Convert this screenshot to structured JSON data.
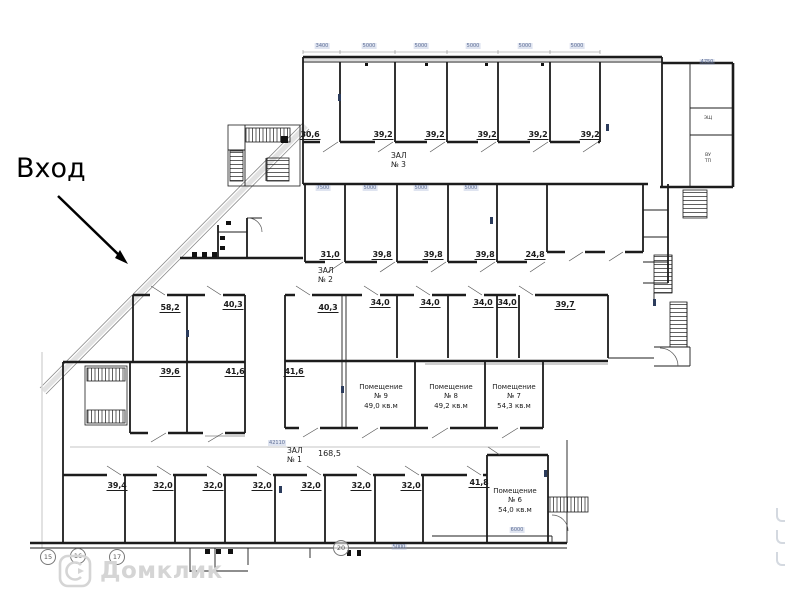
{
  "entrance": {
    "label": "Вход"
  },
  "halls": {
    "hall3": {
      "name": "ЗАЛ",
      "number": "№ 3"
    },
    "hall2": {
      "name": "ЗАЛ",
      "number": "№ 2"
    },
    "hall1": {
      "name": "ЗАЛ",
      "number": "№ 1",
      "area": "168,5"
    }
  },
  "rooms": {
    "band1": [
      "30,6",
      "39,2",
      "39,2",
      "39,2",
      "39,2",
      "39,2"
    ],
    "band2": [
      "31,0",
      "39,8",
      "39,8",
      "39,8",
      "24,8"
    ],
    "band3": [
      "58,2",
      "40,3",
      "40,3",
      "34,0",
      "34,0",
      "34,0",
      "34,0",
      "39,7"
    ],
    "band4": [
      "39,6",
      "41,6",
      "41,6"
    ],
    "band5": [
      "39,4",
      "32,0",
      "32,0",
      "32,0",
      "32,0",
      "32,0",
      "32,0",
      "41,8"
    ]
  },
  "premises": {
    "p9": {
      "title": "Помещение",
      "number": "№ 9",
      "area": "49,0 кв.м"
    },
    "p8": {
      "title": "Помещение",
      "number": "№ 8",
      "area": "49,2 кв.м"
    },
    "p7": {
      "title": "Помещение",
      "number": "№ 7",
      "area": "54,3 кв.м"
    },
    "p6": {
      "title": "Помещение",
      "number": "№ 6",
      "area": "54,0 кв.м"
    }
  },
  "utility": {
    "u1": "ЭЩ",
    "u2": "ВУ",
    "u3": "ТП"
  },
  "axes": [
    "15",
    "16",
    "17",
    "20"
  ],
  "dimensions": {
    "top": [
      "3400",
      "5000",
      "5000",
      "5000",
      "5000",
      "5000"
    ],
    "hall2_top": [
      "7500",
      "5000",
      "5000",
      "5000"
    ],
    "wing_top": "4750",
    "hall1_length": "42110",
    "bottom_1": "5000",
    "bottom_2": "6000"
  },
  "watermark": {
    "brand": "Домклик"
  },
  "colors": {
    "wall": "#1c1c1c",
    "dimension": "#5f6f96",
    "watermark": "#d5d5d5"
  }
}
